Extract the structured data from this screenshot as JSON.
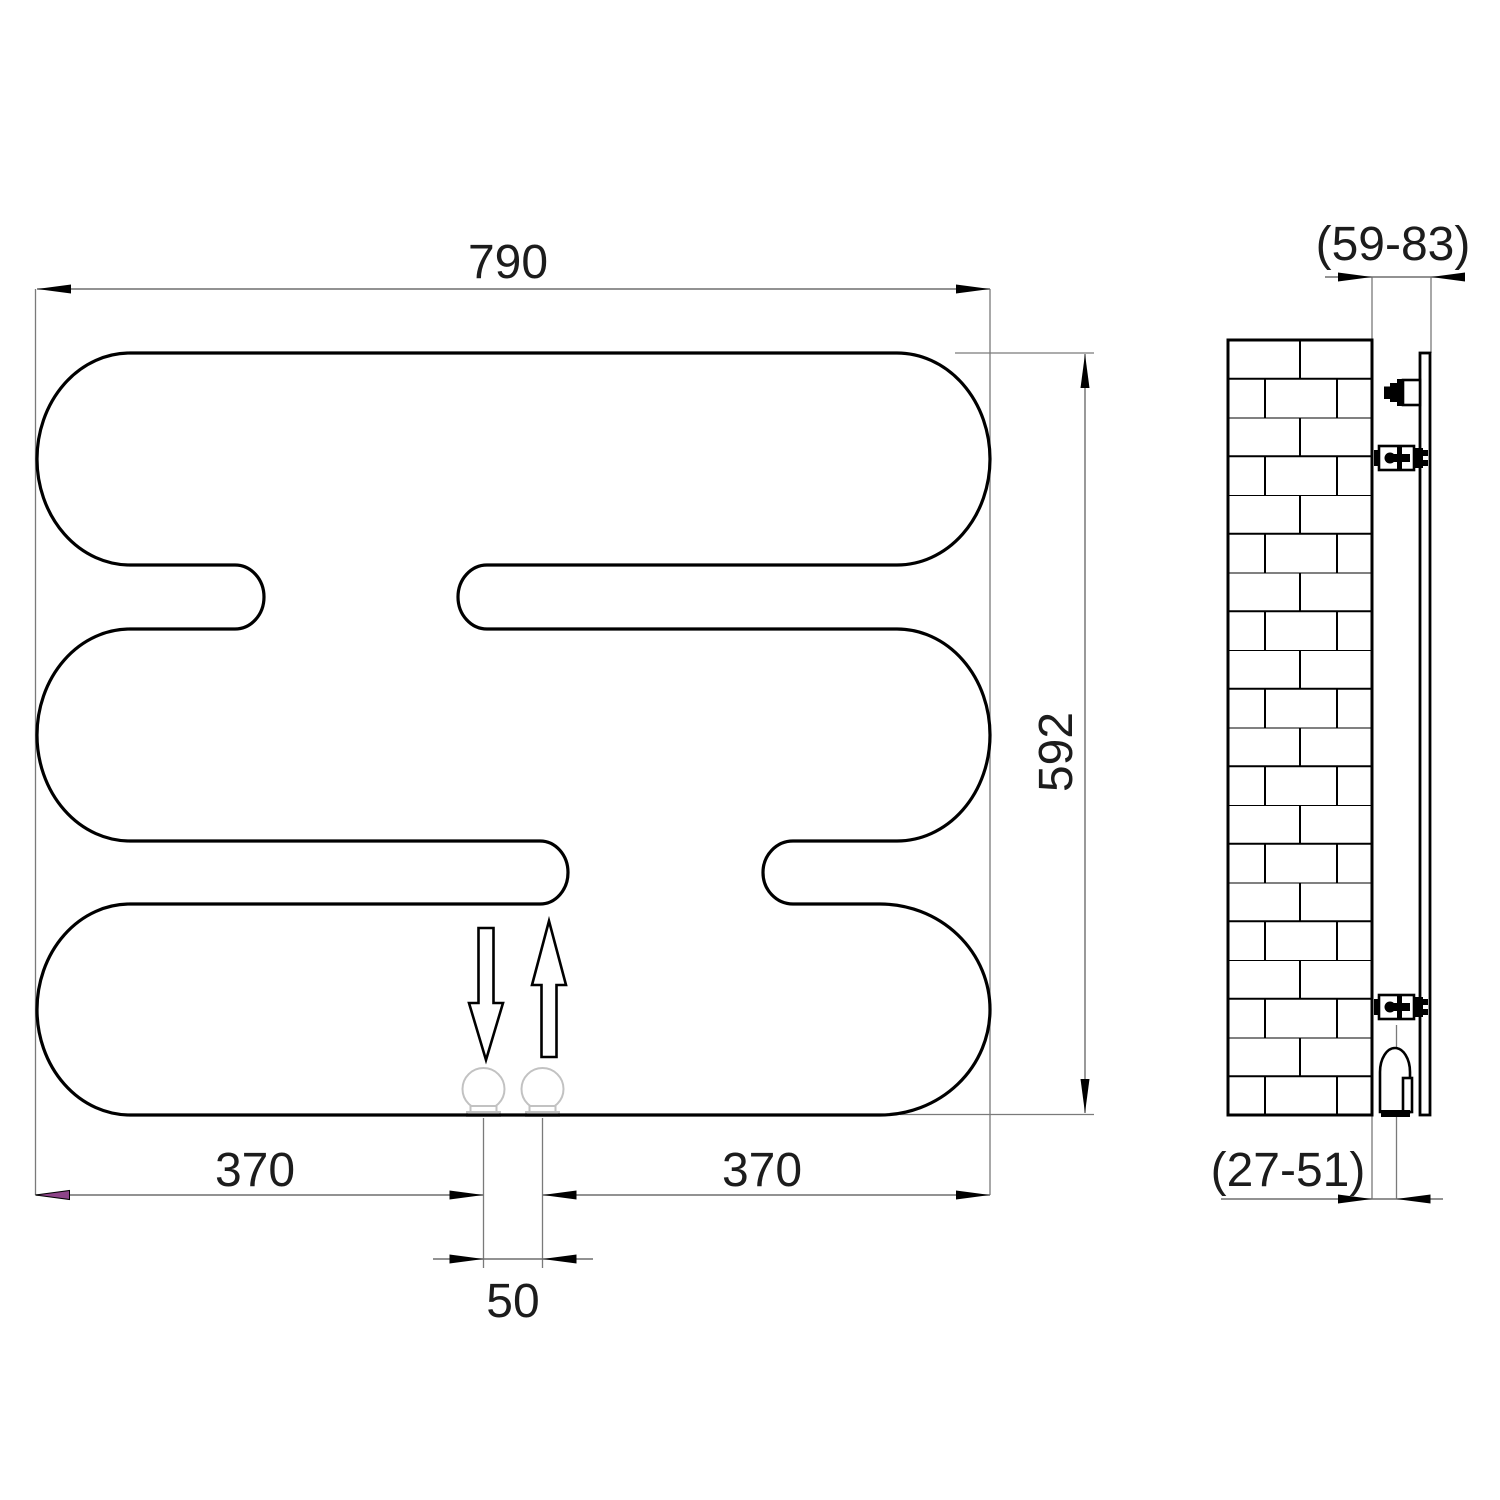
{
  "drawing": {
    "front_view": {
      "width_label": "790",
      "height_label": "592",
      "bottom_left_span_label": "370",
      "bottom_right_span_label": "370",
      "pipe_spacing_label": "50"
    },
    "side_view": {
      "wall_to_front_depth_label": "(59-83)",
      "wall_to_pipe_depth_label": "(27-51)"
    },
    "colors": {
      "line": "#000000",
      "dimension_line": "#6e6e6e",
      "accent_arrowhead": "#8d4488",
      "pipe_gray": "#c2c2c2",
      "background": "#ffffff"
    }
  }
}
